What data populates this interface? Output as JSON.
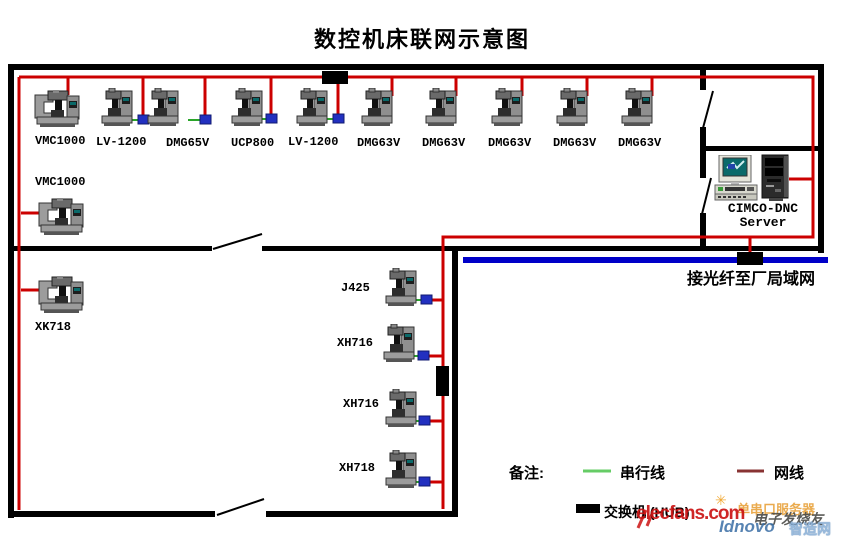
{
  "title": "数控机床联网示意图",
  "machines": [
    {
      "label": "VMC1000"
    },
    {
      "label": "LV-1200"
    },
    {
      "label": "DMG65V"
    },
    {
      "label": "UCP800"
    },
    {
      "label": "LV-1200"
    },
    {
      "label": "DMG63V"
    },
    {
      "label": "DMG63V"
    },
    {
      "label": "DMG63V"
    },
    {
      "label": "DMG63V"
    },
    {
      "label": "DMG63V"
    },
    {
      "label": "VMC1000"
    },
    {
      "label": "XK718"
    },
    {
      "label": "J425"
    },
    {
      "label": "XH716"
    },
    {
      "label": "XH716"
    },
    {
      "label": "XH718"
    }
  ],
  "server": {
    "line1": "CIMCO-DNC",
    "line2": "Server"
  },
  "fiber_label": "接光纤至厂局域网",
  "legend": {
    "note": "备注:",
    "serial": "串行线",
    "network": "网线",
    "hub": "交换机 (HUB)"
  },
  "watermarks": {
    "elecfans": "elecfans.com",
    "serial_server": "单串口服务器",
    "fans": "电子发烧友",
    "idnovo": "Idnovo",
    "zhizao": "智造网",
    "burst": "✳"
  },
  "colors": {
    "network_line": "#cc0000",
    "legend_network_line": "#883333",
    "serial_line": "#2aa52a",
    "legend_serial_line": "#66cc66",
    "fiber_line": "#0000c8",
    "connector": "#2230c0",
    "wall": "#000000",
    "hub": "#000000"
  }
}
